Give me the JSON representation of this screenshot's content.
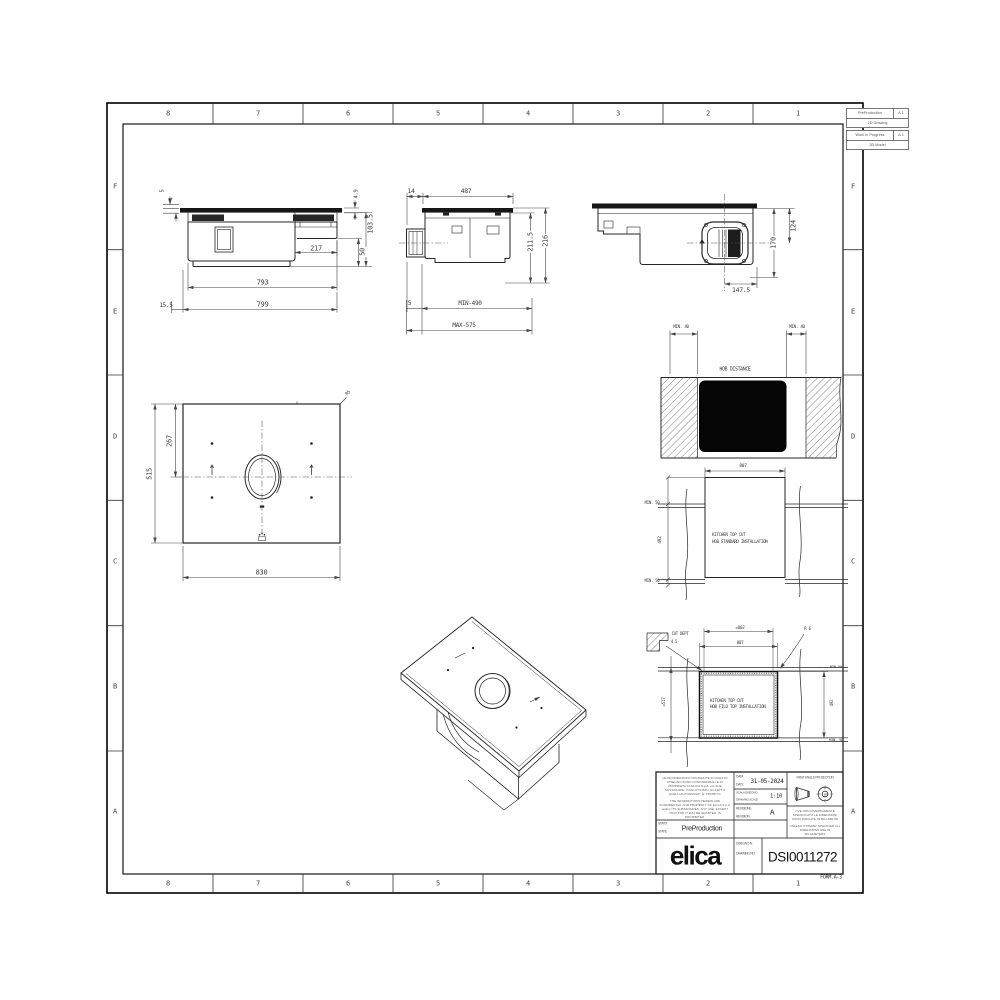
{
  "frame": {
    "cols": [
      "8",
      "7",
      "6",
      "5",
      "4",
      "3",
      "2",
      "1"
    ],
    "rows": [
      "F",
      "E",
      "D",
      "C",
      "B",
      "A"
    ],
    "form_label": "FORM.A-3"
  },
  "status_boxes": {
    "drawing_2d": {
      "status": "PreProduction",
      "rev": "A.1",
      "label": "2D Drawing"
    },
    "model_3d": {
      "status": "Work in Progress",
      "rev": "A.1",
      "label": "3D Model"
    }
  },
  "views": {
    "front": {
      "d_5": "5",
      "d_4": "4",
      "d_4_9": "4.9",
      "d_103_5": "103.5",
      "d_50": "50",
      "d_217": "217",
      "d_793": "793",
      "d_799": "799",
      "d_15_5": "15.5"
    },
    "side": {
      "d_14": "14",
      "d_487": "487",
      "d_211_5": "211.5",
      "d_216": "216",
      "d_5": "5",
      "d_min_490": "MIN-490",
      "d_max_575": "MAX-575"
    },
    "bottom": {
      "d_124": "124",
      "d_170": "170",
      "d_147_5": "147.5"
    },
    "plan": {
      "d_267": "267",
      "d_515": "515",
      "d_830": "830",
      "d_r": "R5"
    },
    "clearance": {
      "min_left": "MIN. 40",
      "min_right": "MIN. 40",
      "title": "HOB DISTANCE"
    },
    "standard_cut": {
      "d_807": "807",
      "min_top": "MIN. 50",
      "d_492": "492",
      "min_bottom": "MIN. 50",
      "caption1": "KITCHEN TOP CUT",
      "caption2": "HOB STANDARD INSTALLATION"
    },
    "filo_cut": {
      "cut_dept_label": "CUT DEPT",
      "cut_dept_value": "4.5",
      "d_802": "=802",
      "d_807": "807",
      "d_r6": "R 6",
      "min_top": "MIN.50",
      "d_492": "492",
      "min_bottom": "MIN. 50",
      "d_517": "=517",
      "caption1": "KITCHEN TOP CUT",
      "caption2": "HOB FILO TOP INSTALLATION"
    }
  },
  "title_block": {
    "confidential_it": "LE INFORMAZIONI CONTENUTE IN QUESTO DISEGNO SONO CONFIDENZIALI E DI PROPRIETA' DI ELICA S.p.A. e/o SUE SUSSIDIARIE. OGNI UTILIZZO, ECCETTO QUELLI AUTORIZZATI, E' PROIBITO.",
    "confidential_en": "THE INFORMATIONS HEREIN ARE CONFIDENTIAL AND PROPERTY OF ELICA S.p.A. and/or ITS SUBSIDIARIES. ANY USE, EXCEPT THAT FOR IT MAY BE GRANTED, IS PROHIBITED.",
    "stato_label": "STATO",
    "state_label": "STATE",
    "state_value": "PreProduction",
    "data_label": "DATA",
    "date_label": "DATE",
    "date_value": "31-05-2024",
    "scala_label": "SCALA DISEGNO",
    "scale_label": "DRAWING SCALE",
    "scale_value": "1:10",
    "revisione_label": "REVISIONE",
    "revision_label": "REVISION",
    "revision_value": "A",
    "projection_label": "FIRST ANGLE PROJECTION",
    "units_it": "OVE NON DIVERSAMENTE SPECIFICATO LE DIMENSIONI SONO INDICATE IN MILLIMETRI",
    "units_en": "UNLESS OTHERW. SPECIFIED ALL DIMENSIONS ARE IN MILLIMETERS",
    "disegno_label": "DISEGNO N.",
    "drawing_no_label": "DRAWING NO.",
    "drawing_no_value": "DSI0011272",
    "logo": "elica"
  }
}
